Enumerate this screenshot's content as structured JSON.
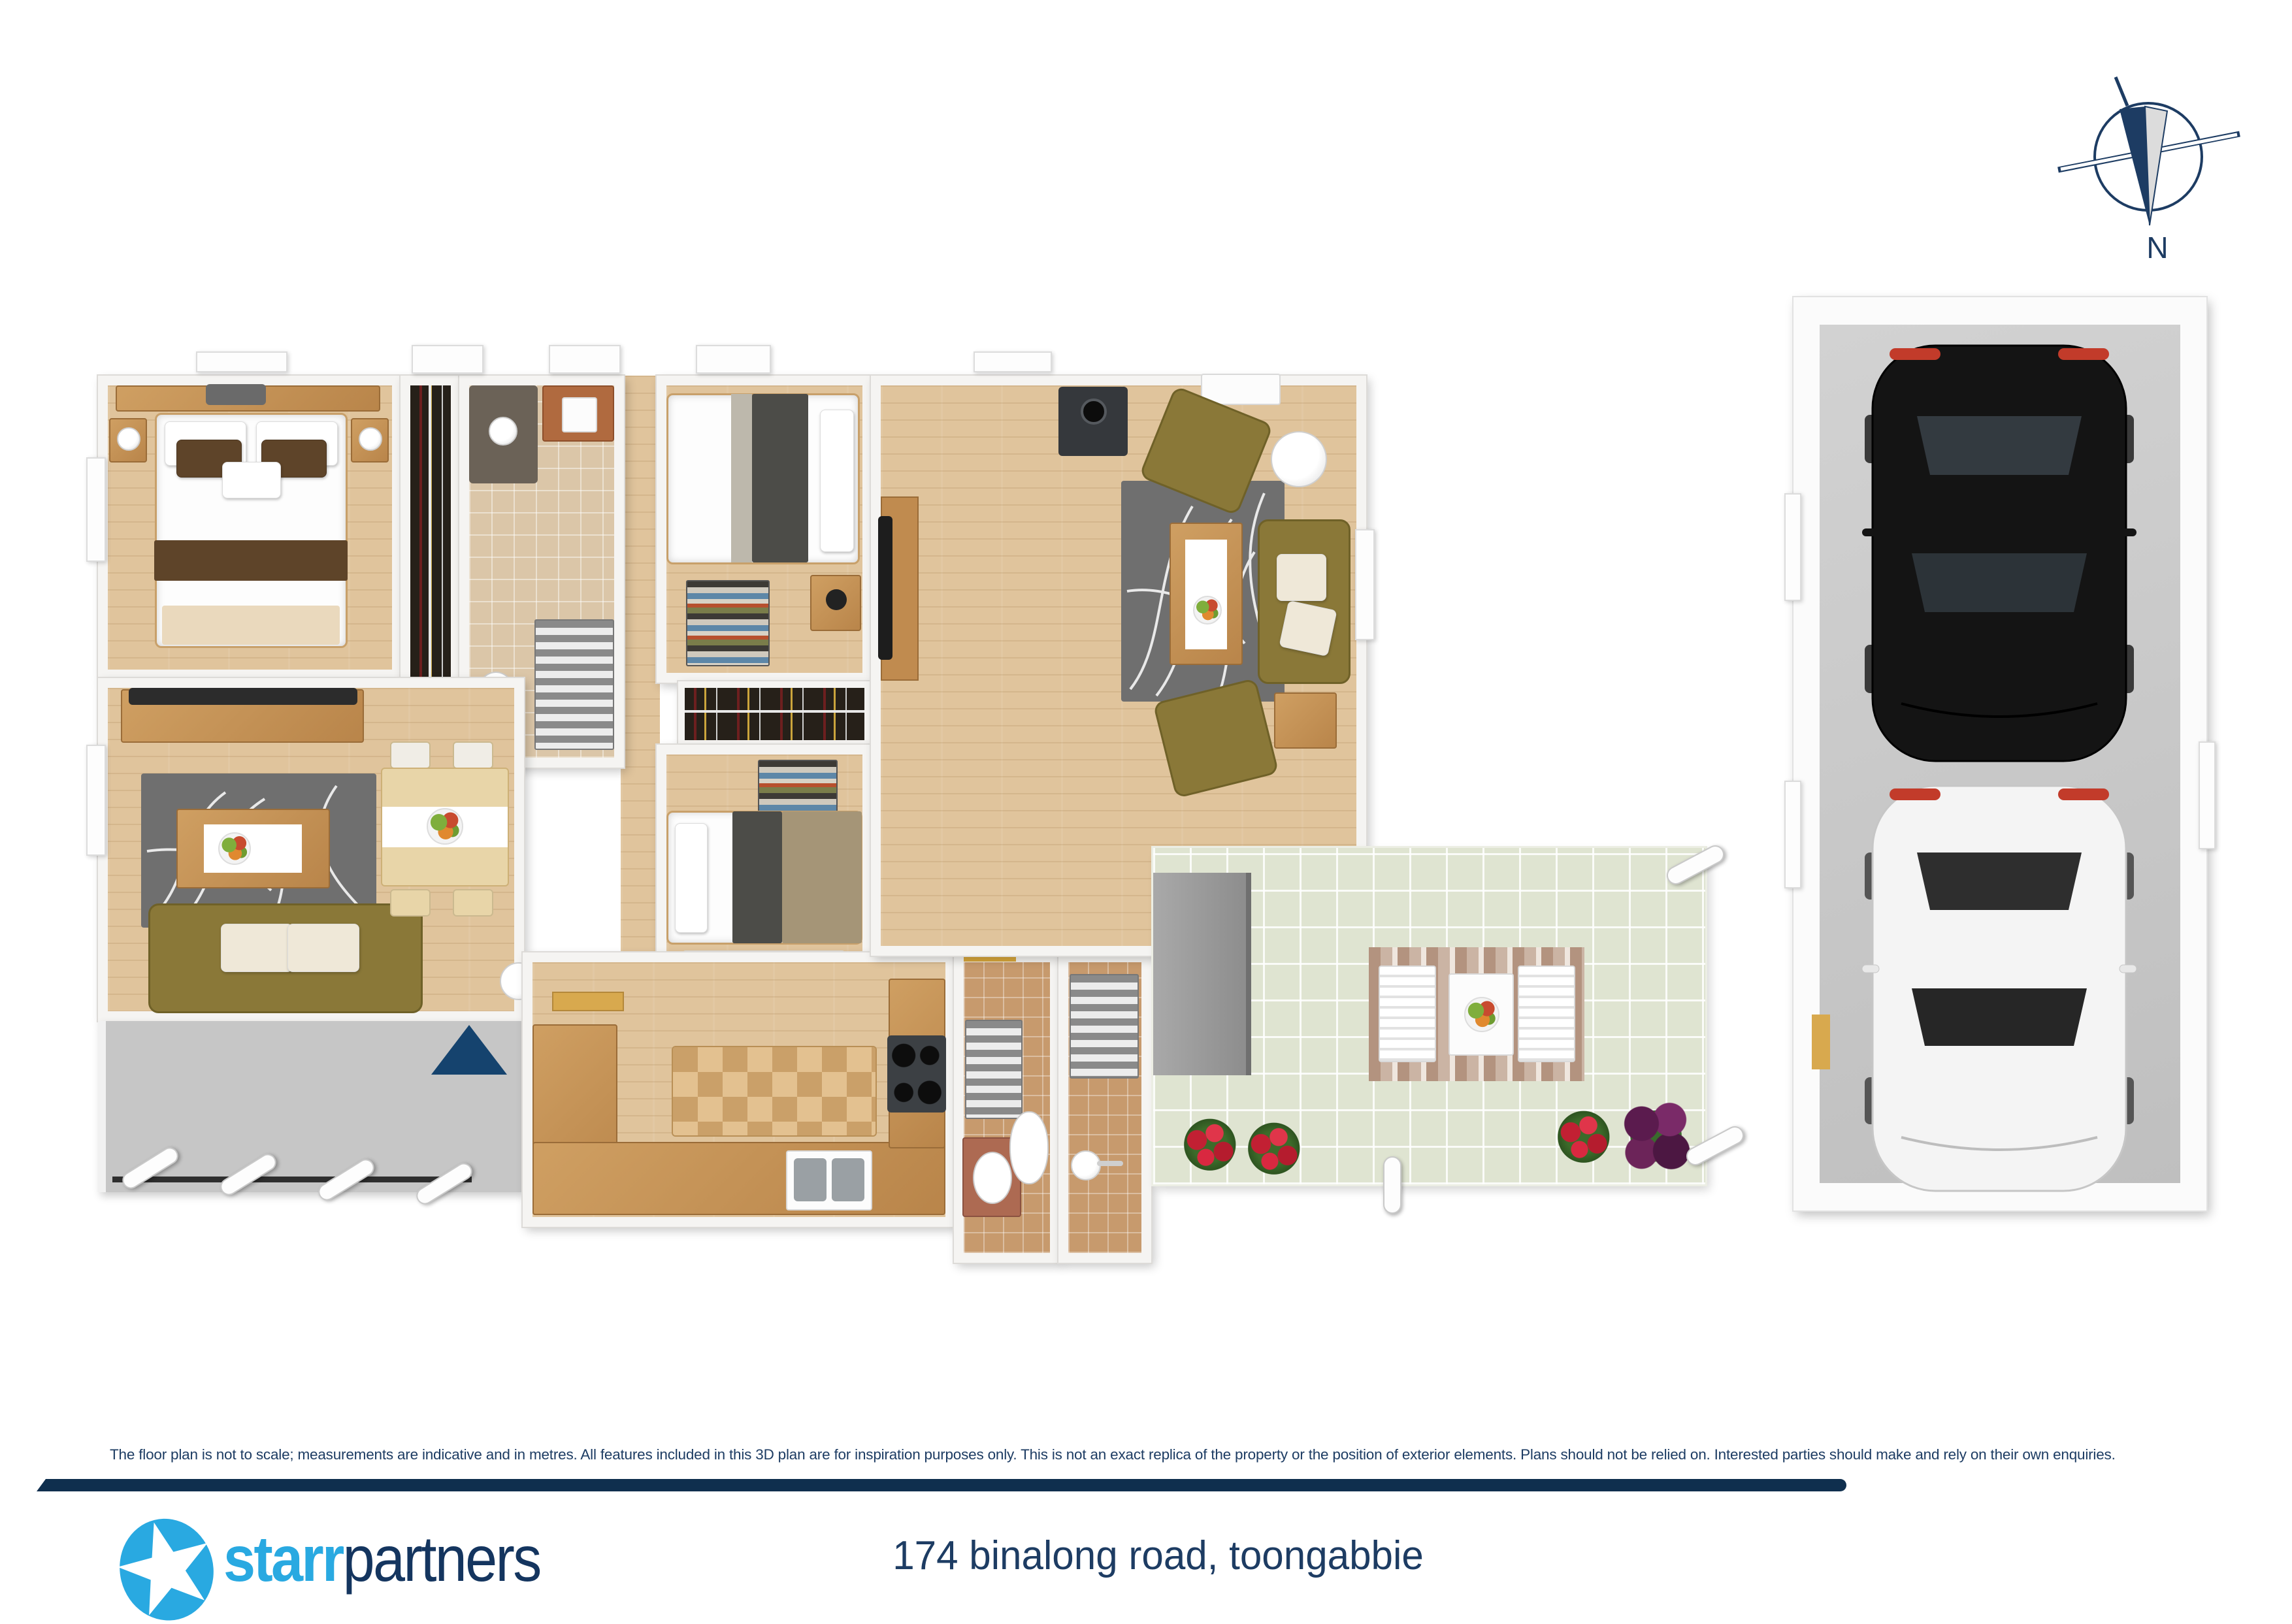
{
  "compass": {
    "label": "N"
  },
  "footer": {
    "disclaimer": "The floor plan is not to scale; measurements are indicative and in metres. All features included in this 3D plan are for inspiration purposes only. This is not an exact replica of the property or the position of exterior elements. Plans should not be relied on. Interested parties should make and rely on their own enquiries.",
    "address": "174 binalong road, toongabbie"
  },
  "logo": {
    "first": "starr",
    "second": "partners"
  },
  "colors": {
    "navy": "#1d3c63",
    "barnavy": "#0f2f4e",
    "blue": "#29a9e1",
    "wood": "#e0c49c",
    "wooddark": "#a87c48",
    "tile": "#dfe4d1",
    "garagefloor": "#c9c9c9",
    "porch": "#c6c6c6",
    "rug": "#6f6f6f",
    "sofa": "#8a7838"
  }
}
